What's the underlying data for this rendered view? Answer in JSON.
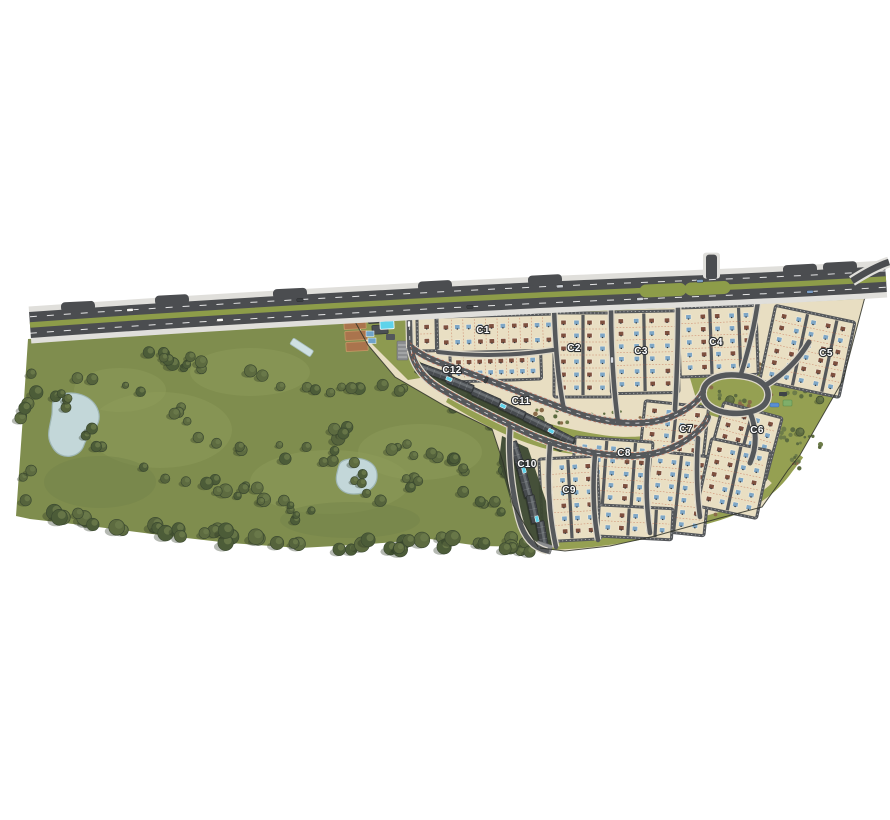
{
  "map": {
    "type": "residential-masterplan",
    "clusters": [
      {
        "id": "c1",
        "label": "C1"
      },
      {
        "id": "c2",
        "label": "C2"
      },
      {
        "id": "c3",
        "label": "C3"
      },
      {
        "id": "c4",
        "label": "C4"
      },
      {
        "id": "c5",
        "label": "C5"
      },
      {
        "id": "c6",
        "label": "C6"
      },
      {
        "id": "c7",
        "label": "C7"
      },
      {
        "id": "c8",
        "label": "C8"
      },
      {
        "id": "c9",
        "label": "C9"
      },
      {
        "id": "c10",
        "label": "C10"
      },
      {
        "id": "c11",
        "label": "C11"
      },
      {
        "id": "c12",
        "label": "C12"
      }
    ],
    "colors": {
      "park_green": "#7f8d4e",
      "park_light": "#8e9c59",
      "buffer_olive": "#95a052",
      "parcel_tan": "#e8dec2",
      "block_tan": "#e9dfc3",
      "road_dark": "#55585b",
      "highway_dark": "#4b4d50",
      "median_green": "#8d9c49",
      "shoulder_gray": "#e0dfdb",
      "water_pond": "#c3d7d9",
      "pool_cyan": "#5ed3ea",
      "house_blue": "#7da6c6",
      "house_brown": "#7e503f",
      "apartment_gray": "#474b4f",
      "tree_green": "#55633c",
      "court_brown": "#aa744d",
      "lot_line_red": "#c2684c"
    }
  }
}
